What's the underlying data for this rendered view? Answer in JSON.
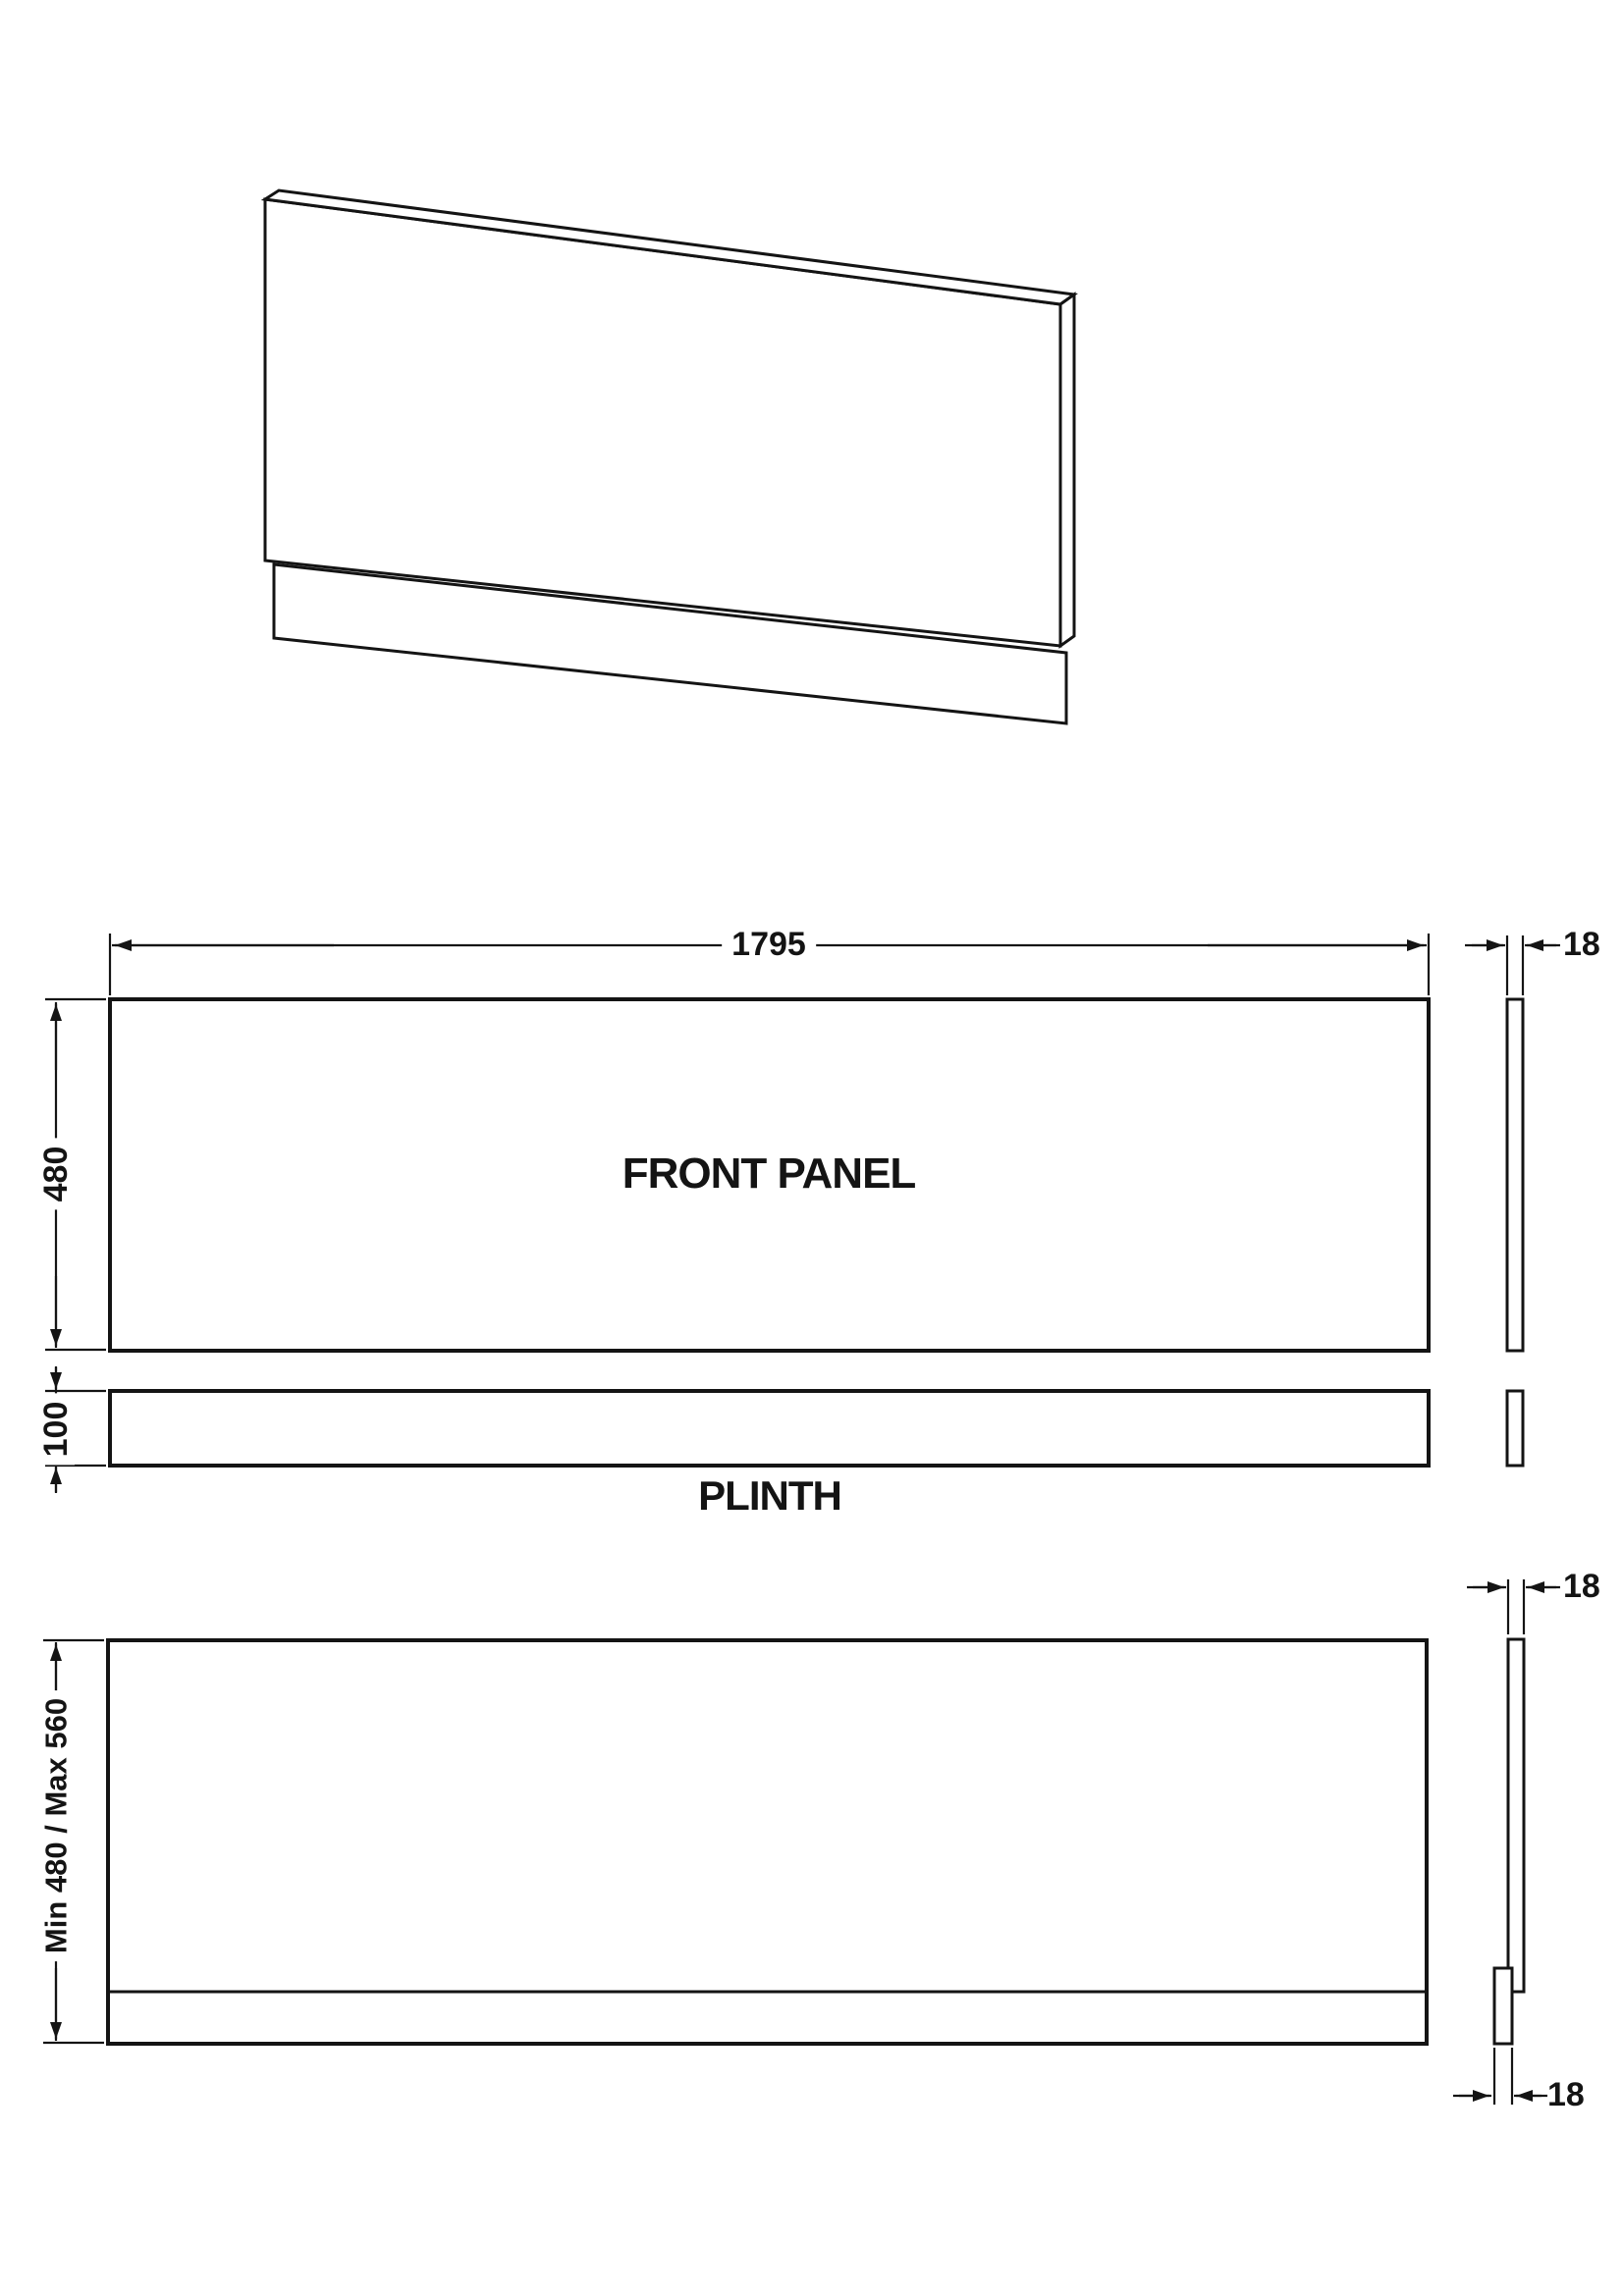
{
  "labels": {
    "front_panel": "FRONT PANEL",
    "plinth": "PLINTH"
  },
  "dimensions": {
    "panel_width": "1795",
    "panel_height": "480",
    "plinth_height": "100",
    "panel_thickness": "18",
    "adjustable_panel_thickness": "18",
    "adjustable_plinth_thickness": "18",
    "adjustable_height_range": "Min 480 / Max 560"
  },
  "colors": {
    "line": "#141414",
    "background": "#ffffff"
  }
}
